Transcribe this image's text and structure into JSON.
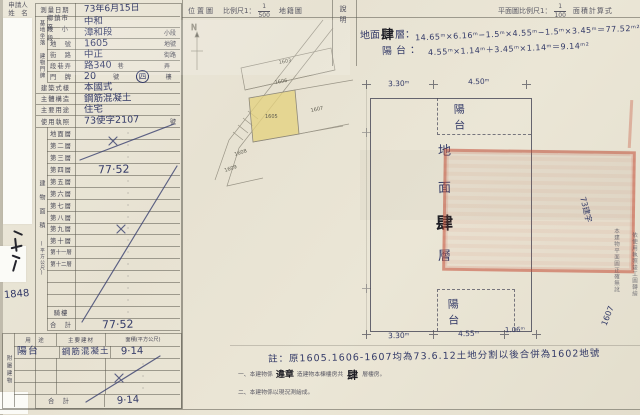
{
  "colors": {
    "paper": "#eae5d5",
    "ink": "#333a68",
    "print": "#4a4a58",
    "seal_red": "#c0503a",
    "parcel_highlight": "#e4d17c"
  },
  "applicant": {
    "line1": "申請人",
    "line2": "姓　名"
  },
  "left_margin": {
    "receipt_number": "1848"
  },
  "survey": {
    "date_label": "測量日期",
    "date_value": "73年6月15日"
  },
  "site": {
    "group": "基地坐落",
    "rows": [
      {
        "label": "鄉鎮市區",
        "value": "中和",
        "suffix": ""
      },
      {
        "label": "段　小段",
        "value": "漳和段",
        "suffix": "小段"
      },
      {
        "label": "地　號",
        "value": "1605",
        "suffix": "地號"
      }
    ]
  },
  "address": {
    "group": "建物門牌",
    "rows": [
      {
        "label": "街　路",
        "value": "中正",
        "suffix": "街路"
      },
      {
        "label": "段巷弄",
        "value": "路340",
        "suffix1": "巷",
        "suffix2": "弄"
      },
      {
        "label": "門　牌",
        "value": "20",
        "suffix_no": "號",
        "floor": "四",
        "suffix_fl": "樓"
      }
    ]
  },
  "building": [
    {
      "label": "建築式樣",
      "value": "本國式",
      "suffix": ""
    },
    {
      "label": "主體構造",
      "value": "鋼筋混凝土",
      "suffix": ""
    },
    {
      "label": "主要用途",
      "value": "住宅",
      "suffix": ""
    },
    {
      "label": "使用執照",
      "value": "73使字2107",
      "suffix": "號"
    }
  ],
  "floor_area": {
    "group": "建物面積",
    "group_unit": "(平方公尺)",
    "rows": [
      {
        "label": "地面層",
        "value": ""
      },
      {
        "label": "第二層",
        "value": ""
      },
      {
        "label": "第三層",
        "value": ""
      },
      {
        "label": "第四層",
        "value": "77·52"
      },
      {
        "label": "第五層",
        "value": ""
      },
      {
        "label": "第六層",
        "value": ""
      },
      {
        "label": "第七層",
        "value": ""
      },
      {
        "label": "第八層",
        "value": ""
      },
      {
        "label": "第九層",
        "value": ""
      },
      {
        "label": "第十層",
        "value": ""
      },
      {
        "label": "第十一層",
        "value": ""
      },
      {
        "label": "第十二層",
        "value": ""
      },
      {
        "label": "",
        "value": ""
      },
      {
        "label": "",
        "value": ""
      },
      {
        "label": "",
        "value": ""
      },
      {
        "label": "騎樓",
        "value": ""
      },
      {
        "label": "合　計",
        "value": "77·52"
      }
    ]
  },
  "annex": {
    "group": "附屬建物",
    "headers": [
      "用　途",
      "主要建材",
      "面積(平方公尺)"
    ],
    "row": {
      "use": "陽台",
      "material": "鋼筋混凝土",
      "area": "9·14"
    },
    "total_label": "合　計",
    "total": "9·14"
  },
  "location_map": {
    "title": "位置圖",
    "scale_label": "比例尺1：",
    "scale_num": "1",
    "scale_den": "500",
    "map_type": "地籍圖",
    "north": "N",
    "parcels": [
      "1603",
      "1606",
      "1605",
      "1607",
      "1608",
      "1609"
    ]
  },
  "plan": {
    "note_col": "說明",
    "header_label": "平面圖比例尺1：",
    "scale_num": "1",
    "scale_den": "100",
    "calc_label": "面積計算式",
    "formula1_prefix": "地面",
    "formula1_bold": "肆",
    "formula1_mid": "層：",
    "formula1": "14.65ᵐ×6.16ᵐ−1.5ᵐ×4.55ᵐ−1.5ᵐ×3.45ᵐ＝77.52ᵐ²",
    "formula2_label": "陽台：",
    "formula2": "4.55ᵐ×1.14ᵐ＋3.45ᵐ×1.14ᵐ＝9.14ᵐ²",
    "dims_top": [
      "3.30ᵐ",
      "4.50ᵐ"
    ],
    "dims_bottom": [
      "3.30ᵐ",
      "4.55ᵐ",
      "1.06ᵐ"
    ],
    "balcony": "陽　台",
    "room": [
      "地",
      "面",
      "肆",
      "層"
    ]
  },
  "margin_right": {
    "col1": "本建物平面圖正確無訛",
    "col2": "依使用執照竣工圖轉繪",
    "hand_a": "73建字",
    "hand_b": "1607"
  },
  "notes": {
    "hand": "註：原1605.1606-1607均為73.6.12土地分割以後合併為1602地號",
    "l1a": "一、本建物係",
    "l1b": "違章",
    "l1c": "造建物本棟樓房共",
    "l1d": "肆",
    "l1e": "層樓房。",
    "l2": "二、本建物係以現況測繪成。"
  }
}
